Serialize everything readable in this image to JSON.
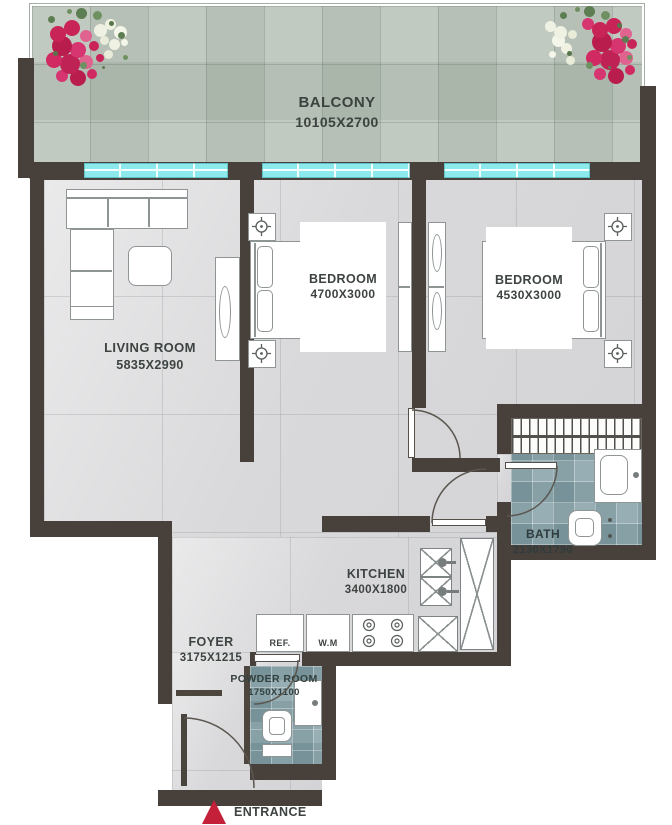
{
  "rooms": {
    "balcony": {
      "name": "BALCONY",
      "dimensions": "10105X2700"
    },
    "living_room": {
      "name": "LIVING ROOM",
      "dimensions": "5835X2990"
    },
    "bedroom_1": {
      "name": "BEDROOM",
      "dimensions": "4700X3000"
    },
    "bedroom_2": {
      "name": "BEDROOM",
      "dimensions": "4530X3000"
    },
    "bath": {
      "name": "BATH",
      "dimensions": "2130X1790"
    },
    "kitchen": {
      "name": "KITCHEN",
      "dimensions": "3400X1800"
    },
    "foyer": {
      "name": "FOYER",
      "dimensions": "3175X1215"
    },
    "powder_room": {
      "name": "POWDER ROOM",
      "dimensions": "1750X1100"
    }
  },
  "appliances": {
    "refrigerator": "REF.",
    "washing_machine": "W.M"
  },
  "entrance": {
    "label": "ENTRANCE",
    "marker_color": "#c5203a"
  },
  "colors": {
    "wall": "#48413b",
    "floor_tile": "#d9d9db",
    "balcony_tile": "#b9c3b9",
    "wet_room_tile": "#87a2a8",
    "window_glass": "#8ce9ec",
    "label_text": "#3d4341",
    "entrance_red": "#c5203a"
  }
}
